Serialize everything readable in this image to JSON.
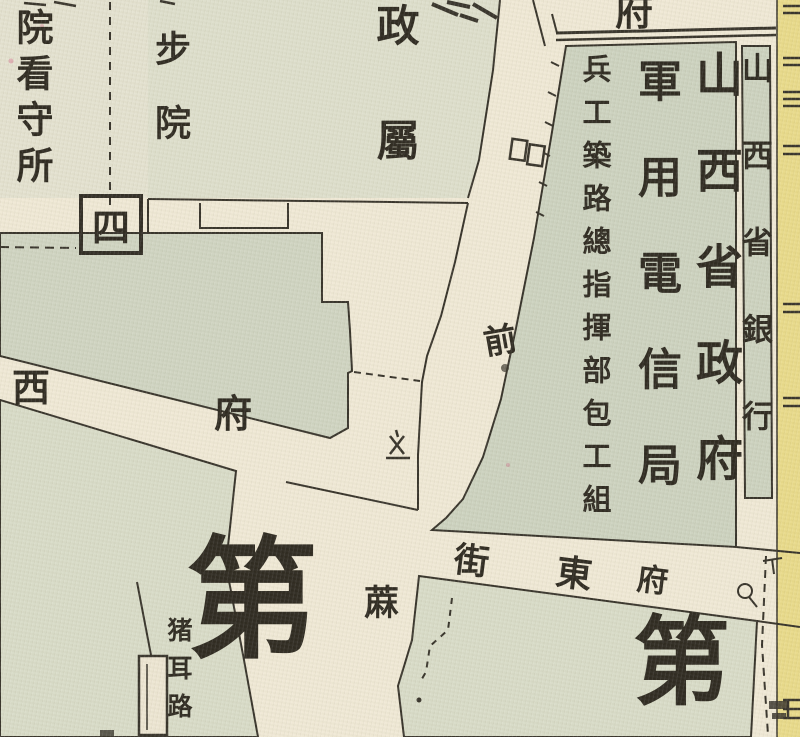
{
  "map": {
    "colors": {
      "paper": "#efe8d5",
      "street": "#f2ecda",
      "block_green": "#ccd2bf",
      "block_light": "#d8dbc7",
      "pale_block": "#e3e1cf",
      "yellow_strip": "#e8da8a",
      "ink": "#35312a"
    },
    "building_labels": {
      "detention_house": "院看守所",
      "court_partial": "步院",
      "district_number": "四",
      "government_branch_partial": "政屬",
      "fu_partial": "府",
      "shanxi_provincial_government": "山西省政府",
      "military_telegraph_bureau": "軍用電信局",
      "road_construction_hq": "兵工築路總指揮部包工組",
      "shanxi_provincial_bank": "山西省銀行",
      "di_large_left": "第",
      "di_large_right": "第",
      "zhuer_lane": "猪耳路"
    },
    "street_labels": {
      "fuxi_xi": "西",
      "fuxi_fu": "府",
      "qian": "前",
      "fudong_jie": "街",
      "fudong_dong": "東",
      "fudong_fu": "府",
      "ma": "蔴"
    },
    "symbols": {
      "gate_marker": "double-square gate symbol",
      "monument_marker": "monument symbol",
      "circle_marker": "circled point with tail",
      "district_box": "square frame around district numeral"
    }
  }
}
